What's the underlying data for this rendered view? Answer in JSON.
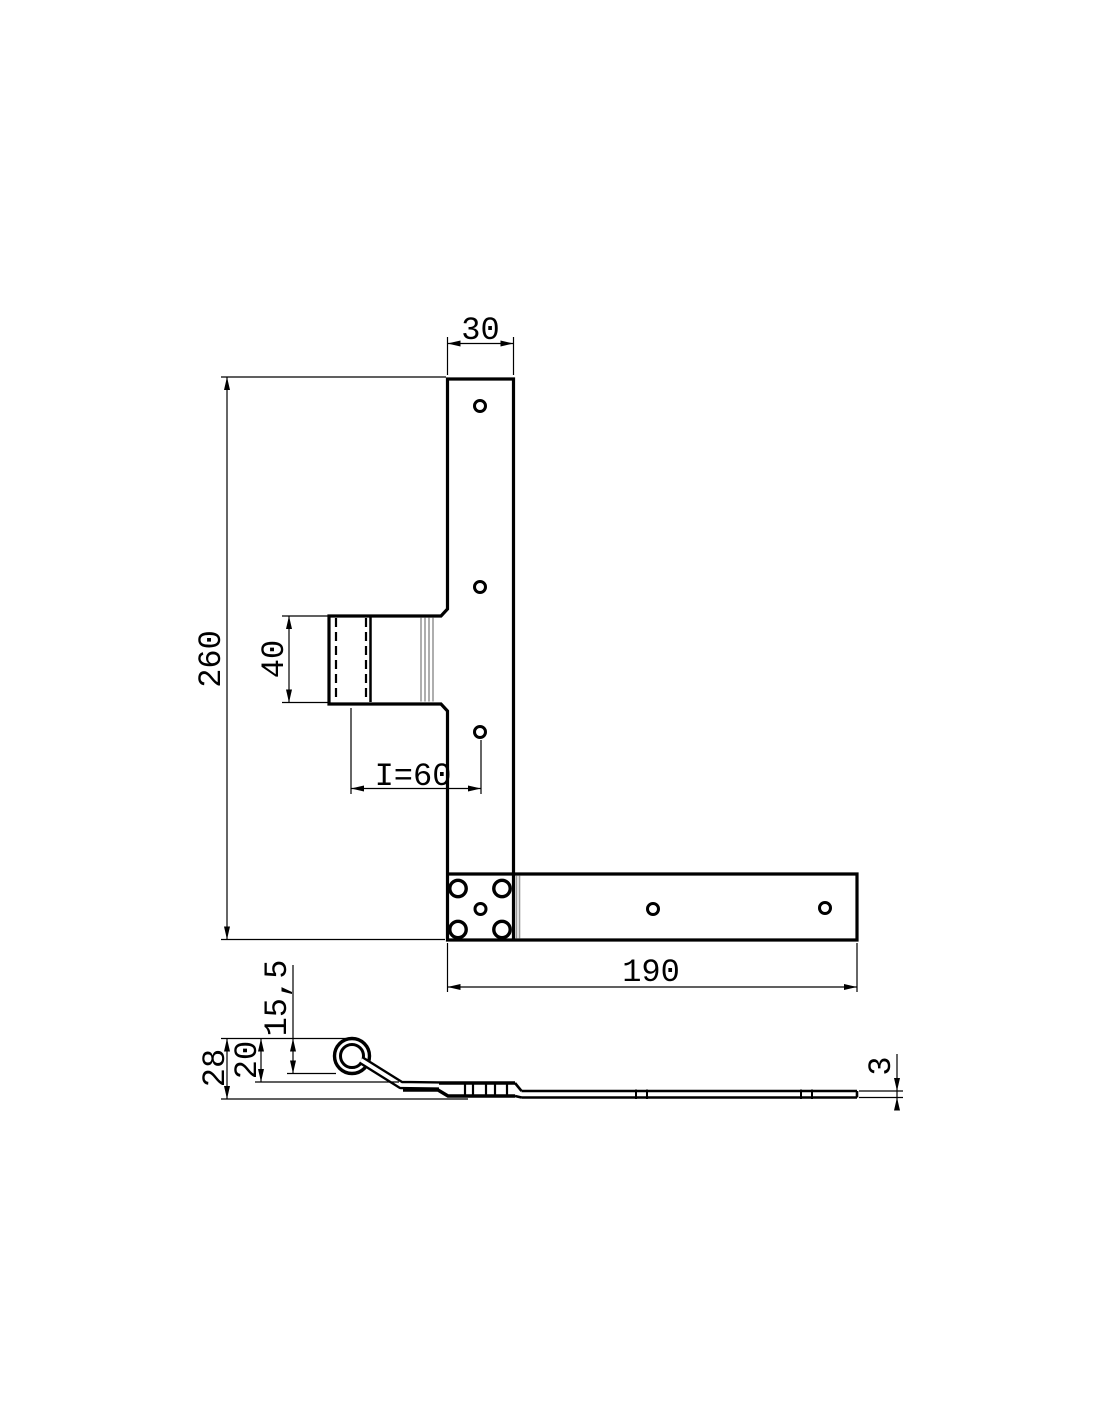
{
  "drawing": {
    "type": "technical-drawing-angle-hinge",
    "front_view": {
      "dim_strap_width": "30",
      "dim_total_height": "260",
      "dim_knuckle_length": "40",
      "dim_pin_to_hole": "I=60",
      "dim_arm_length": "190"
    },
    "side_view": {
      "dim_total_height": "28",
      "dim_offset": "20",
      "dim_barrel_diameter": "15,5",
      "dim_material_thickness": "3"
    },
    "colors": {
      "line": "#000000",
      "hatch": "#999999",
      "background": "#ffffff"
    }
  }
}
